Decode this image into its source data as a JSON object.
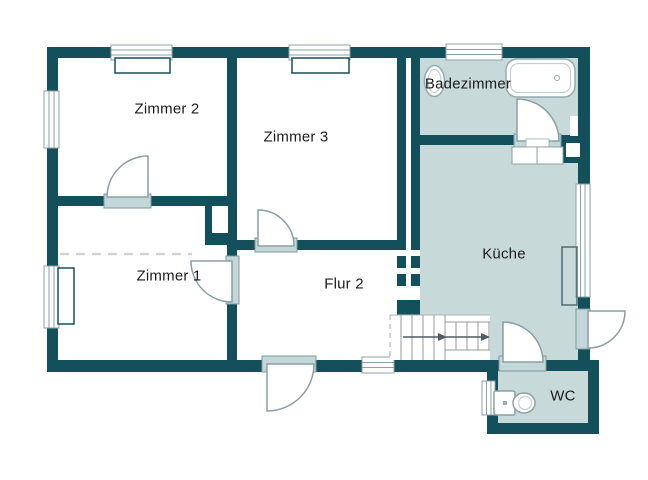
{
  "meta": {
    "type": "floor-plan"
  },
  "rooms": [
    {
      "name": "zimmer-2",
      "label": "Zimmer 2"
    },
    {
      "name": "zimmer-3",
      "label": "Zimmer 3"
    },
    {
      "name": "badezimmer",
      "label": "Badezimmer"
    },
    {
      "name": "zimmer-1",
      "label": "Zimmer 1"
    },
    {
      "name": "flur-2",
      "label": "Flur 2"
    },
    {
      "name": "kueche",
      "label": "Küche"
    },
    {
      "name": "wc",
      "label": "WC"
    }
  ],
  "fixtures": [
    "bathtub",
    "sink",
    "toilet",
    "staircase",
    "kitchen-counter",
    "cabinet"
  ],
  "colors": {
    "wall": "#14505c",
    "room_fill": "#c8d9da",
    "threshold_fill": "#c3d6d8",
    "threshold_border": "#7d989e",
    "fixture_outline": "#8aa0a4",
    "stair_line": "#999999",
    "dashed_line": "#cfd4d4",
    "text": "#1c1c1c",
    "background": "#ffffff"
  }
}
